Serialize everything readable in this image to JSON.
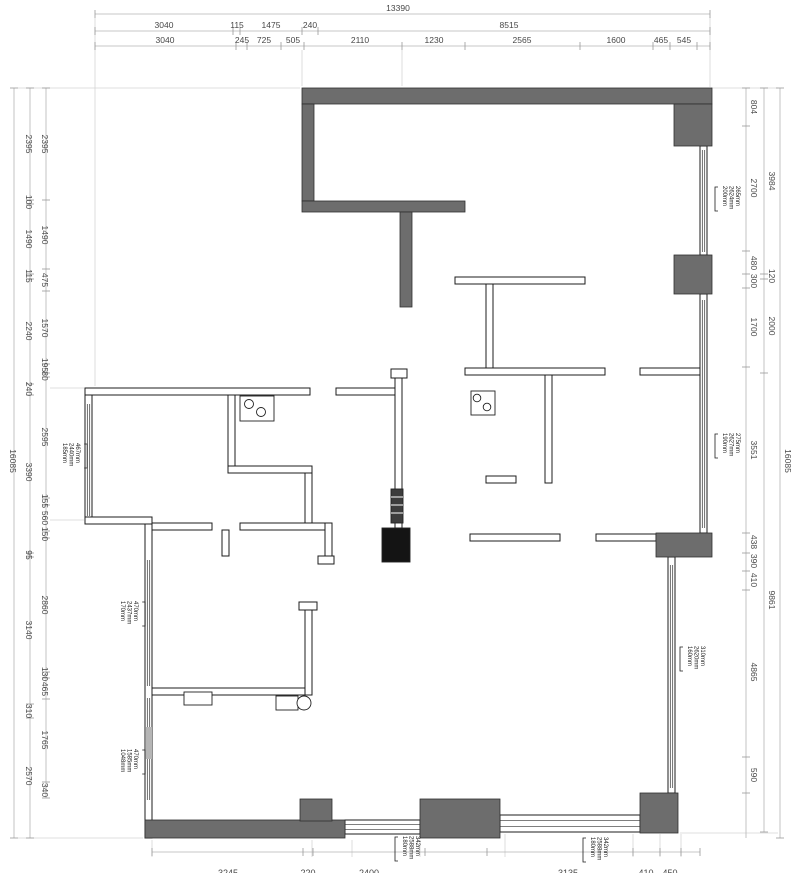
{
  "colors": {
    "wall_dark": "#6d6d6d",
    "wall_dark_stroke": "#2f2f2f",
    "thin_wall_stroke": "#1c1c1c",
    "window_line": "#333333",
    "dim_line": "#b4b4b4",
    "dim_tick": "#999999",
    "dim_text": "#474747",
    "tag_text": "#1f1f1f",
    "extension_line": "#d4d4d4",
    "appliance_dark": "#141414"
  },
  "totals": {
    "overall_width": "13390",
    "overall_height": "16085"
  },
  "dim_chains": [
    {
      "name": "top-total",
      "o": "h",
      "line": 14,
      "from": 95,
      "to": 710,
      "loff": -3,
      "ticks": [
        95,
        710
      ],
      "labels": [
        {
          "t": "13390",
          "p": 398
        }
      ]
    },
    {
      "name": "top-row2",
      "o": "h",
      "line": 31,
      "from": 95,
      "to": 710,
      "loff": -3,
      "ticks": [
        95,
        233,
        240,
        302,
        318,
        710
      ],
      "labels": [
        {
          "t": "3040",
          "p": 164
        },
        {
          "t": "115",
          "p": 237
        },
        {
          "t": "1475",
          "p": 271
        },
        {
          "t": "240",
          "p": 310
        },
        {
          "t": "8515",
          "p": 509
        }
      ]
    },
    {
      "name": "top-row3",
      "o": "h",
      "line": 46,
      "from": 95,
      "to": 710,
      "loff": -3,
      "ticks": [
        95,
        236,
        247,
        281,
        304,
        402,
        465,
        580,
        653,
        670,
        697,
        710
      ],
      "labels": [
        {
          "t": "3040",
          "p": 165
        },
        {
          "t": "245",
          "p": 242
        },
        {
          "t": "725",
          "p": 264
        },
        {
          "t": "505",
          "p": 293
        },
        {
          "t": "2110",
          "p": 360
        },
        {
          "t": "1230",
          "p": 434
        },
        {
          "t": "2565",
          "p": 522
        },
        {
          "t": "1600",
          "p": 616
        },
        {
          "t": "465",
          "p": 661
        },
        {
          "t": "545",
          "p": 684
        }
      ]
    },
    {
      "name": "left-total",
      "o": "v",
      "line": 14,
      "from": 88,
      "to": 838,
      "loff": -4,
      "ticks": [
        88,
        838
      ],
      "labels": [
        {
          "t": "16085",
          "p": 461
        }
      ]
    },
    {
      "name": "left-outer",
      "o": "v",
      "line": 30,
      "from": 88,
      "to": 838,
      "loff": -4,
      "ticks": [
        88,
        200,
        204,
        274,
        279,
        384,
        395,
        553,
        557,
        704,
        718,
        838
      ],
      "labels": [
        {
          "t": "2395",
          "p": 144
        },
        {
          "t": "100",
          "p": 202
        },
        {
          "t": "1490",
          "p": 239
        },
        {
          "t": "115",
          "p": 276
        },
        {
          "t": "2240",
          "p": 331
        },
        {
          "t": "240",
          "p": 389
        },
        {
          "t": "3390",
          "p": 472
        },
        {
          "t": "95",
          "p": 555
        },
        {
          "t": "3140",
          "p": 630
        },
        {
          "t": "310",
          "p": 711
        },
        {
          "t": "2570",
          "p": 776
        }
      ]
    },
    {
      "name": "left-inner",
      "o": "v",
      "line": 46,
      "from": 88,
      "to": 798,
      "loff": -4,
      "ticks": [
        88,
        200,
        269,
        291,
        364,
        373,
        377,
        498,
        505,
        531,
        538,
        672,
        678,
        699,
        782,
        798
      ],
      "labels": [
        {
          "t": "2395",
          "p": 144
        },
        {
          "t": "1490",
          "p": 235
        },
        {
          "t": "475",
          "p": 280
        },
        {
          "t": "1570",
          "p": 328
        },
        {
          "t": "195",
          "p": 365
        },
        {
          "t": "80",
          "p": 376
        },
        {
          "t": "2595",
          "p": 437
        },
        {
          "t": "155",
          "p": 501
        },
        {
          "t": "560",
          "p": 518
        },
        {
          "t": "150",
          "p": 534
        },
        {
          "t": "2860",
          "p": 605
        },
        {
          "t": "130",
          "p": 674
        },
        {
          "t": "465",
          "p": 689
        },
        {
          "t": "1765",
          "p": 740
        },
        {
          "t": "340",
          "p": 790
        }
      ]
    },
    {
      "name": "right-inner",
      "o": "v",
      "line": 746,
      "from": 88,
      "to": 838,
      "loff": 5,
      "ticks": [
        88,
        126,
        251,
        274,
        288,
        367,
        533,
        553,
        571,
        590,
        757,
        793
      ],
      "labels": [
        {
          "t": "804",
          "p": 107
        },
        {
          "t": "2700",
          "p": 188
        },
        {
          "t": "480",
          "p": 263
        },
        {
          "t": "300",
          "p": 281
        },
        {
          "t": "1700",
          "p": 327
        },
        {
          "t": "3551",
          "p": 450
        },
        {
          "t": "438",
          "p": 542
        },
        {
          "t": "390",
          "p": 561
        },
        {
          "t": "410",
          "p": 580
        },
        {
          "t": "4865",
          "p": 672
        },
        {
          "t": "590",
          "p": 775
        }
      ]
    },
    {
      "name": "right-outer",
      "o": "v",
      "line": 764,
      "from": 88,
      "to": 832,
      "loff": 5,
      "ticks": [
        88,
        274,
        279,
        373,
        832
      ],
      "labels": [
        {
          "t": "3984",
          "p": 181
        },
        {
          "t": "120",
          "p": 276
        },
        {
          "t": "2000",
          "p": 326
        },
        {
          "t": "9861",
          "p": 600
        }
      ]
    },
    {
      "name": "right-total",
      "o": "v",
      "line": 780,
      "from": 88,
      "to": 838,
      "loff": 5,
      "ticks": [
        88,
        838
      ],
      "labels": [
        {
          "t": "16085",
          "p": 461
        }
      ]
    },
    {
      "name": "bottom",
      "o": "h",
      "line": 852,
      "from": 152,
      "to": 700,
      "loff": 24,
      "fs": 9,
      "ticks": [
        152,
        303,
        313,
        425,
        487,
        633,
        660,
        681,
        700
      ],
      "labels": [
        {
          "t": "3245",
          "p": 228
        },
        {
          "t": "220",
          "p": 308
        },
        {
          "t": "2400",
          "p": 369
        },
        {
          "t": "3135",
          "p": 568
        },
        {
          "t": "410",
          "p": 646
        },
        {
          "t": "450",
          "p": 670
        }
      ]
    }
  ],
  "window_tags": [
    {
      "name": "window-tag-right-top",
      "x": 719,
      "y": 186,
      "br": "l",
      "cols": [
        "200mm",
        "2624mm",
        "265mm"
      ]
    },
    {
      "name": "window-tag-right-mid",
      "x": 719,
      "y": 433,
      "br": "l",
      "cols": [
        "190mm",
        "2627mm",
        "275mm"
      ]
    },
    {
      "name": "window-tag-right-low",
      "x": 684,
      "y": 646,
      "br": "l",
      "cols": [
        "160mm",
        "2620mm",
        "310mm"
      ]
    },
    {
      "name": "window-tag-left-top",
      "x": 59,
      "y": 443,
      "br": "r",
      "cols": [
        "185mm",
        "2440mm",
        "467mm"
      ]
    },
    {
      "name": "window-tag-left-mid",
      "x": 117,
      "y": 601,
      "br": "r",
      "cols": [
        "170mm",
        "2437mm",
        "470mm"
      ]
    },
    {
      "name": "window-tag-left-low",
      "x": 117,
      "y": 749,
      "br": "r",
      "cols": [
        "1048mm",
        "1585mm",
        "470mm"
      ]
    },
    {
      "name": "window-tag-bottom-left",
      "x": 399,
      "y": 836,
      "br": "l",
      "cols": [
        "180mm",
        "2588mm",
        "342mm"
      ]
    },
    {
      "name": "window-tag-bottom-right",
      "x": 587,
      "y": 837,
      "br": "l",
      "cols": [
        "180mm",
        "2588mm",
        "342mm"
      ]
    }
  ]
}
